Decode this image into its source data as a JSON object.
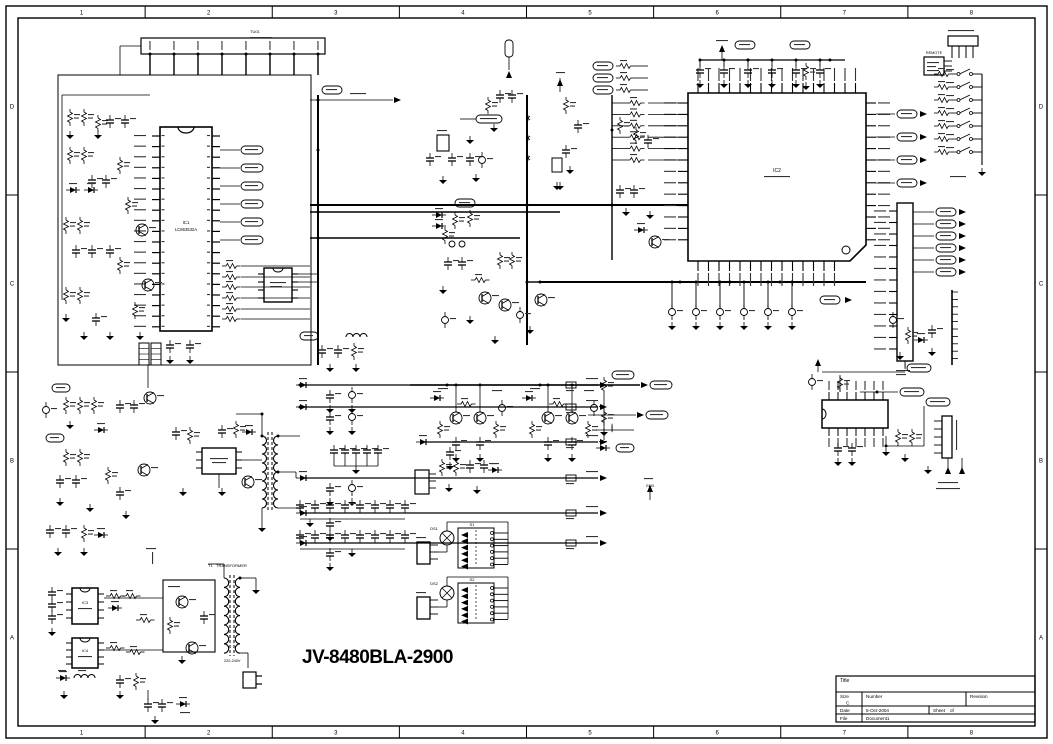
{
  "sheet": {
    "main_title": "JV-8480BLA-2900",
    "border": {
      "columns": [
        "1",
        "2",
        "3",
        "4",
        "5",
        "6",
        "7",
        "8"
      ],
      "rows": [
        "D",
        "C",
        "B",
        "A"
      ]
    },
    "title_block": {
      "title_label": "Title",
      "size_label": "Size",
      "size_value": "C",
      "number_label": "Number",
      "revision_label": "Revision",
      "date_label": "Date",
      "date_value": "5-Oct-2004",
      "sheet_label": "Sheet",
      "of_label": "of",
      "file_label": "File",
      "file_value": "Document1"
    },
    "labels": {
      "ic1_ref": "IC1",
      "ic1_part": "LC863532A",
      "ic2_ref": "IC2",
      "tuner_ref": "TU01",
      "t1_ref": "T1",
      "t1_name": "TRANSFORMER",
      "remote": "REMOTE",
      "s1": "S1",
      "s2": "S2",
      "ds1": "DS1",
      "ds2": "DS2",
      "ic3_ref": "IC3",
      "ic4_ref": "IC4",
      "mains": "220-240V",
      "gnd_flag": "GND"
    }
  }
}
